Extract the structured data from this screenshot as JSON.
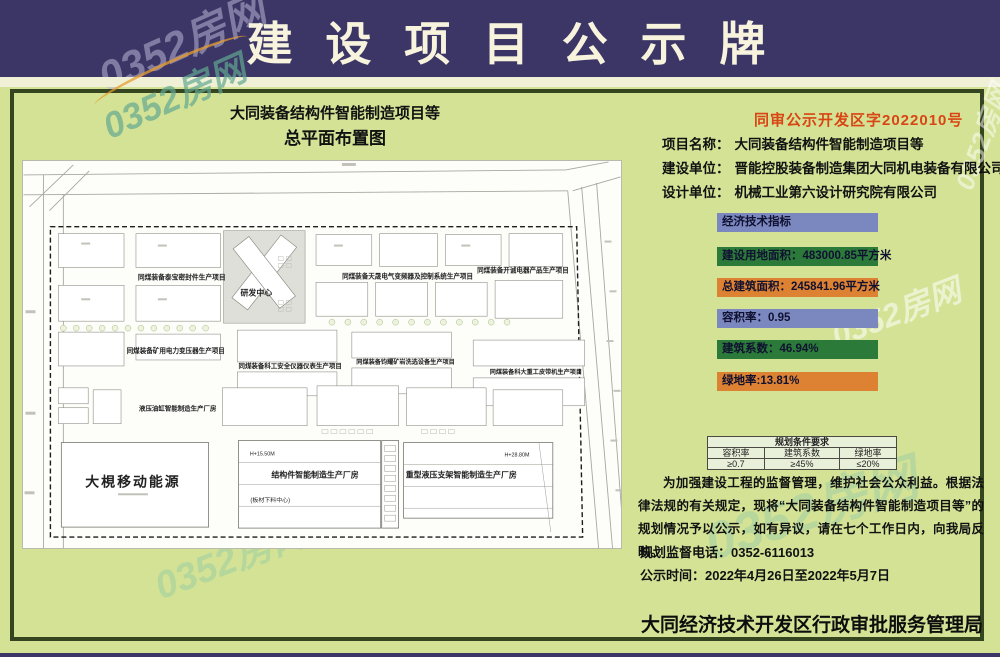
{
  "header": {
    "title": "建 设 项 目 公 示 牌"
  },
  "watermark": {
    "text": "0352房网"
  },
  "map": {
    "title_line1": "大同装备结构件智能制造项目等",
    "title_line2": "总平面布置图",
    "zones": {
      "taibao": "同煤装备泰宝密封件生产项目",
      "rd_center": "研发中心",
      "tiansheng": "同煤装备天晟电气变频器及控制系统生产项目",
      "kaicheng": "同煤装备开诚电器产品生产项目",
      "kuangyong": "同煤装备矿用电力变压器生产项目",
      "kegong": "同煤装备科工安全仪器仪表生产项目",
      "junyao": "同煤装备钧耀矿岩洗选设备生产项目",
      "keda": "同煤装备科大重工皮带机生产项目",
      "yeya": "液压油缸智能制造生产厂房",
      "daju": "大梘移动能源",
      "jiegou": "结构件智能制造生产厂房",
      "jiegou_sub": "(板材下料中心)",
      "zhongxing": "重型液压支架智能制造生产厂房",
      "h_left": "H+15.50M",
      "h_right": "H+28.80M"
    }
  },
  "info": {
    "doc_no": "同审公示开发区字2022010号",
    "fields": [
      {
        "label": "项目名称：",
        "value": "大同装备结构件智能制造项目等"
      },
      {
        "label": "建设单位：",
        "value": "晋能控股装备制造集团大同机电装备有限公司"
      },
      {
        "label": "设计单位：",
        "value": "机械工业第六设计研究院有限公司"
      }
    ],
    "indicators": [
      {
        "text": "经济技术指标",
        "color": "blue"
      },
      {
        "text": "建设用地面积：483000.85平方米",
        "color": "green"
      },
      {
        "text": "总建筑面积：245841.96平方米",
        "color": "orange"
      },
      {
        "text": "容积率：0.95",
        "color": "blue"
      },
      {
        "text": "建筑系数：46.94%",
        "color": "green"
      },
      {
        "text": "绿地率:13.81%",
        "color": "orange"
      }
    ],
    "cond_table": {
      "title": "规划条件要求",
      "headers": [
        "容积率",
        "建筑系数",
        "绿地率"
      ],
      "values": [
        "≥0.7",
        "≥45%",
        "≤20%"
      ]
    },
    "paragraph": "为加强建设工程的监督管理，维护社会公众利益。根据法律法规的有关规定，现将“大同装备结构件智能制造项目等”的规划情况予以公示，如有异议，请在七个工作日内，向我局反映。",
    "phone": {
      "label": "规划监督电话：",
      "value": "0352-6116013"
    },
    "period": {
      "label": "公示时间：",
      "value": "2022年4月26日至2022年5月7日"
    },
    "agency": "大同经济技术开发区行政审批服务管理局"
  },
  "colors": {
    "header_bg": "#3b3666",
    "board_bg": "#d3e295",
    "frame": "#35451f",
    "bar_blue": "#7b88c0",
    "bar_green": "#2b7a3a",
    "bar_orange": "#dd8233",
    "doc_no_red": "#d94513"
  }
}
